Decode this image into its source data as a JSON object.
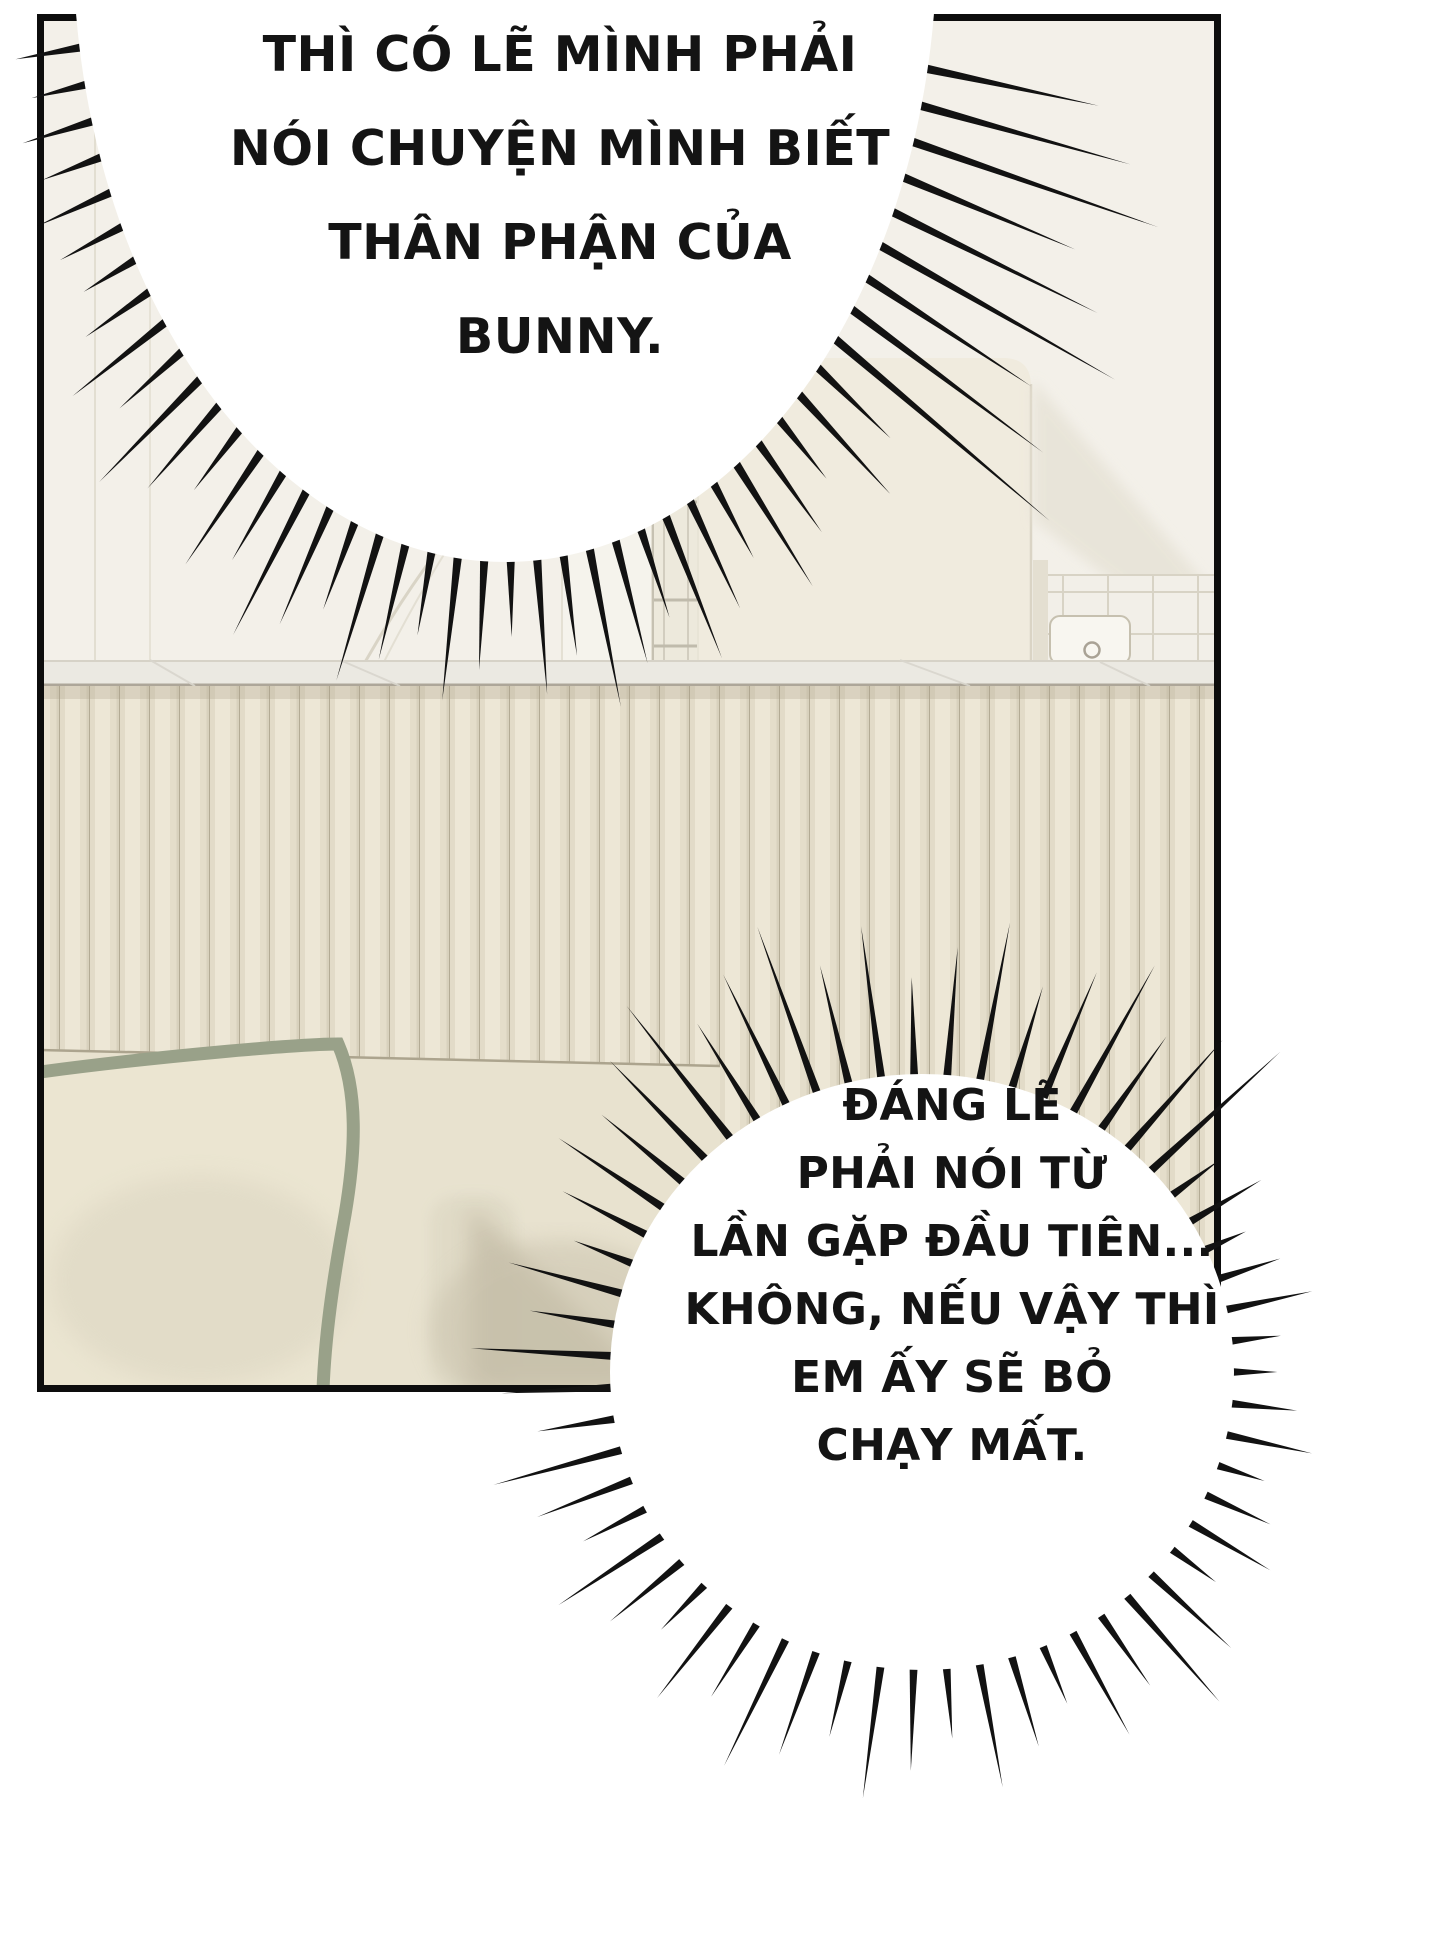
{
  "page": {
    "background": "#ffffff",
    "ink": "#121212"
  },
  "panel": {
    "border_color": "#0d0d0d"
  },
  "bubbles": {
    "top": {
      "shape": "burst",
      "fill": "#ffffff",
      "lines": [
        "THÌ CÓ LẼ MÌNH PHẢI",
        "NÓI CHUYỆN MÌNH BIẾT",
        "THÂN PHẬN CỦA",
        "BUNNY."
      ]
    },
    "bottom": {
      "shape": "burst",
      "fill": "#ffffff",
      "lines": [
        "ĐÁNG LẼ",
        "PHẢI NÓI TỪ",
        "LẦN GẶP ĐẦU TIÊN...",
        "KHÔNG, NẾU VẬY THÌ",
        "EM ẤY SẼ BỎ",
        "CHẠY MẤT."
      ]
    }
  },
  "scene": {
    "setting": "cream interior: fluted wood wainscot, marble ledge, arched wall, door frame, cabinet, tiled corner with paper holder, sofa with sage-piped pillow",
    "colors": {
      "upper_wall": "#F3F0E9",
      "pillar": "#F5F3EC",
      "cabinet": "#F0EBDE",
      "marble": "#EBE9E2",
      "slat_base": "#EDE7D6",
      "slat_line": "#B3AB95",
      "couch": "#E8E2CF",
      "pillow": "#EBE5D1",
      "piping": "#99A189",
      "shadow": "#C7C0AA"
    }
  }
}
